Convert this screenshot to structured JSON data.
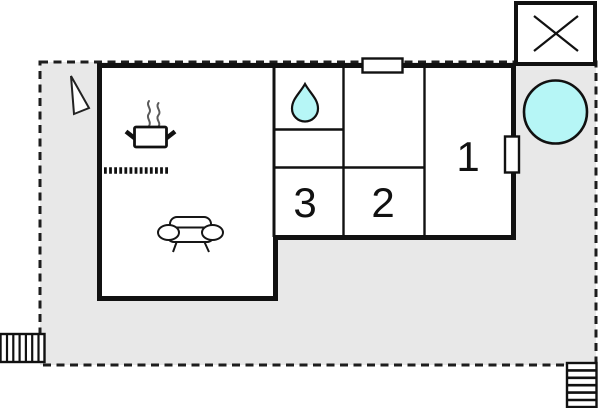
{
  "plan": {
    "rooms": [
      {
        "id": "room-1",
        "label": "1"
      },
      {
        "id": "room-2",
        "label": "2"
      },
      {
        "id": "room-3",
        "label": "3"
      }
    ]
  },
  "colors": {
    "plot_fill": "#e8e8e8",
    "water": "#b6f6f6",
    "wall": "#111111",
    "steam": "#5a5a5a",
    "dash": "#1d1d1d"
  },
  "icons": {
    "hot_tub_icon": "cyan circle (outdoor hot tub)",
    "water_drop_icon": "cyan teardrop (bathroom)",
    "cooking_pot_icon": "pot with side handles (kitchen hob)",
    "steam_icon": "two wavy steam lines",
    "sofa_icon": "sofa seen from front (living room)",
    "kitchen_counter_dots": "dotted worktop line",
    "window_marker": "white rectangle in top wall",
    "door_marker": "white rectangle in right wall",
    "x_marked_structure_icon": "square with diagonal cross (annex/carport)",
    "stairs_left_icon": "hatched steps, vertical treads",
    "stairs_right_icon": "hatched steps, horizontal treads",
    "north_triangle_icon": "small triangle pointer on terrace"
  }
}
